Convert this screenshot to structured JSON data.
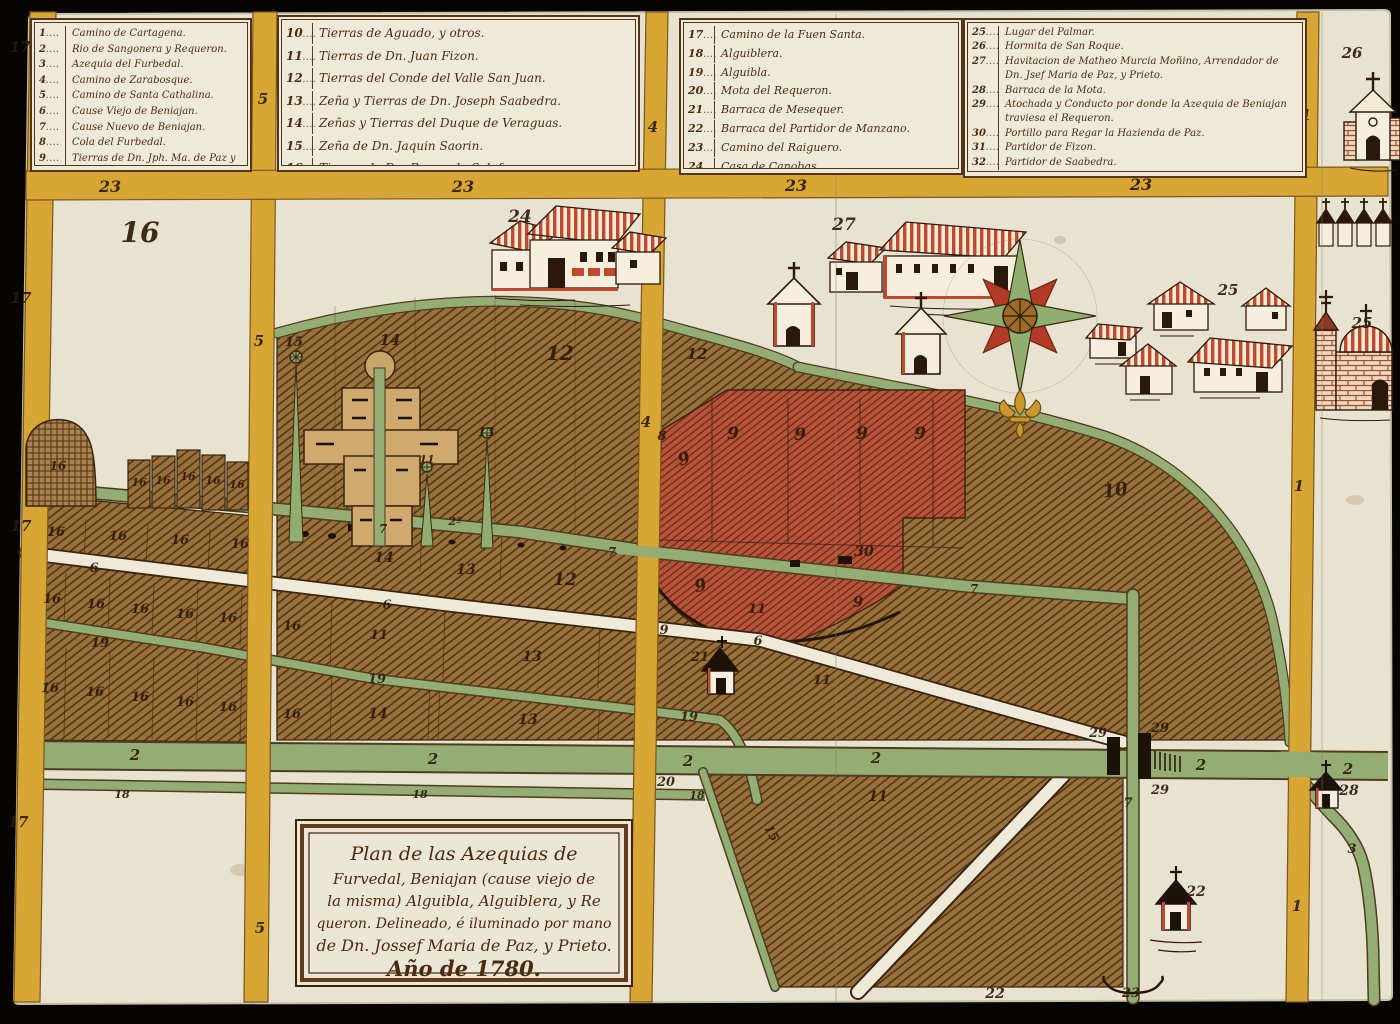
{
  "document_title": "Plan de las Azequias de Furvedal, Beniajan, Alguibla, Alguiblera y Requeron (1780)",
  "legend": {
    "boxes": [
      {
        "items": [
          {
            "num": "1",
            "text": "Camino de Cartagena."
          },
          {
            "num": "2",
            "text": "Rio de Sangonera y Requeron."
          },
          {
            "num": "3",
            "text": "Azequia del Furbedal."
          },
          {
            "num": "4",
            "text": "Camino de Zarabosque."
          },
          {
            "num": "5",
            "text": "Camino de Santa Cathalina."
          },
          {
            "num": "6",
            "text": "Cause Viejo de Beniajan."
          },
          {
            "num": "7",
            "text": "Cause Nuevo de Beniajan."
          },
          {
            "num": "8",
            "text": "Cola del Furbedal."
          },
          {
            "num": "9",
            "text": "Tierras de Dn. Jph. Ma. de Paz y Prieto."
          }
        ]
      },
      {
        "items": [
          {
            "num": "10",
            "text": "Tierras de Aguado, y otros."
          },
          {
            "num": "11",
            "text": "Tierras de Dn. Juan Fizon."
          },
          {
            "num": "12",
            "text": "Tierras del Conde del Valle San Juan."
          },
          {
            "num": "13",
            "text": "Zeña y Tierras de Dn. Joseph Saabedra."
          },
          {
            "num": "14",
            "text": "Zeñas y Tierras del Duque de Veraguas."
          },
          {
            "num": "15",
            "text": "Zeña de Dn. Jaquin Saorin."
          },
          {
            "num": "16",
            "text": "Tierras de Dn. Bernardo Salafranca."
          }
        ]
      },
      {
        "items": [
          {
            "num": "17",
            "text": "Camino de la Fuen Santa."
          },
          {
            "num": "18",
            "text": "Alguiblera."
          },
          {
            "num": "19",
            "text": "Alguibla."
          },
          {
            "num": "20",
            "text": "Mota del Requeron."
          },
          {
            "num": "21",
            "text": "Barraca de Mesequer."
          },
          {
            "num": "22",
            "text": "Barraca del Partidor de Manzano."
          },
          {
            "num": "23",
            "text": "Camino del Raiguero."
          },
          {
            "num": "24",
            "text": "Casa de Canobas."
          }
        ]
      },
      {
        "items": [
          {
            "num": "25",
            "text": "Lugar del Palmar."
          },
          {
            "num": "26",
            "text": "Hormita de San Roque."
          },
          {
            "num": "27",
            "text": "Havitacion de Matheo Murcia Moñino, Arrendador de Dn. Jsef Maria de Paz, y Prieto."
          },
          {
            "num": "28",
            "text": "Barraca de la Mota."
          },
          {
            "num": "29",
            "text": "Atochada y Conducto por donde la Azequia de Beniajan traviesa el Requeron."
          },
          {
            "num": "30",
            "text": "Portillo para Regar la Hazienda de Paz."
          },
          {
            "num": "31",
            "text": "Partidor de Fizon."
          },
          {
            "num": "32",
            "text": "Partidor de Saabedra."
          }
        ]
      }
    ]
  },
  "cartouche": {
    "lines": [
      "Plan de las Azequias de",
      "Furvedal, Beniajan (cause viejo de",
      "la misma) Alguibla, Alguiblera, y Re",
      "queron. Delineado, é iluminado por mano",
      "de Dn. Jossef Maria de Paz, y Prieto.",
      "Año de 1780."
    ]
  },
  "map": {
    "colors": {
      "parchment": "#e8e2d0",
      "legend_parchment": "#efe9da",
      "road_yellow": "#d7a634",
      "canal_green": "#93ad74",
      "field_brown": "#98713c",
      "red_parcel": "#b5543c",
      "roof_red": "#bf4a2e",
      "ink": "#2e1b08",
      "black_bg": "#060503"
    },
    "labels": [
      {
        "t": "17",
        "x": 20,
        "y": 52,
        "s": 15
      },
      {
        "t": "17",
        "x": 21,
        "y": 303,
        "s": 15
      },
      {
        "t": "17",
        "x": 21,
        "y": 531,
        "s": 15
      },
      {
        "t": "17",
        "x": 18,
        "y": 827,
        "s": 15
      },
      {
        "t": "5",
        "x": 263,
        "y": 104,
        "s": 15
      },
      {
        "t": "5",
        "x": 259,
        "y": 346,
        "s": 15
      },
      {
        "t": "5",
        "x": 260,
        "y": 933,
        "s": 15
      },
      {
        "t": "4",
        "x": 653,
        "y": 132,
        "s": 15
      },
      {
        "t": "4",
        "x": 646,
        "y": 427,
        "s": 15
      },
      {
        "t": "1",
        "x": 1306,
        "y": 120,
        "s": 15
      },
      {
        "t": "1",
        "x": 1299,
        "y": 491,
        "s": 15
      },
      {
        "t": "1",
        "x": 1297,
        "y": 911,
        "s": 15
      },
      {
        "t": "23",
        "x": 110,
        "y": 192,
        "s": 16
      },
      {
        "t": "23",
        "x": 463,
        "y": 192,
        "s": 16
      },
      {
        "t": "23",
        "x": 796,
        "y": 191,
        "s": 16
      },
      {
        "t": "23",
        "x": 1141,
        "y": 190,
        "s": 16
      },
      {
        "t": "16",
        "x": 140,
        "y": 242,
        "s": 28
      },
      {
        "t": "24",
        "x": 520,
        "y": 222,
        "s": 17
      },
      {
        "t": "27",
        "x": 844,
        "y": 230,
        "s": 17
      },
      {
        "t": "25",
        "x": 1228,
        "y": 295,
        "s": 15
      },
      {
        "t": "25",
        "x": 1362,
        "y": 328,
        "s": 15
      },
      {
        "t": "26",
        "x": 1352,
        "y": 58,
        "s": 15
      },
      {
        "t": "15",
        "x": 294,
        "y": 346,
        "s": 13
      },
      {
        "t": "14",
        "x": 390,
        "y": 345,
        "s": 15
      },
      {
        "t": "13",
        "x": 486,
        "y": 436,
        "s": 12
      },
      {
        "t": "11",
        "x": 427,
        "y": 463,
        "s": 11
      },
      {
        "t": "12",
        "x": 560,
        "y": 360,
        "s": 20
      },
      {
        "t": "12",
        "x": 697,
        "y": 359,
        "s": 15
      },
      {
        "t": "10",
        "x": 1116,
        "y": 496,
        "s": 18,
        "r": -8
      },
      {
        "t": "8",
        "x": 662,
        "y": 440,
        "s": 13
      },
      {
        "t": "9",
        "x": 686,
        "y": 464,
        "s": 17,
        "r": -20
      },
      {
        "t": "9",
        "x": 733,
        "y": 439,
        "s": 17
      },
      {
        "t": "9",
        "x": 800,
        "y": 440,
        "s": 17
      },
      {
        "t": "9",
        "x": 862,
        "y": 439,
        "s": 17
      },
      {
        "t": "9",
        "x": 920,
        "y": 439,
        "s": 17
      },
      {
        "t": "9",
        "x": 702,
        "y": 591,
        "s": 17,
        "r": -15
      },
      {
        "t": "9",
        "x": 858,
        "y": 607,
        "s": 15
      },
      {
        "t": "9",
        "x": 664,
        "y": 634,
        "s": 13
      },
      {
        "t": "30",
        "x": 864,
        "y": 556,
        "s": 14
      },
      {
        "t": "7",
        "x": 383,
        "y": 533,
        "s": 12
      },
      {
        "t": "7",
        "x": 612,
        "y": 556,
        "s": 12
      },
      {
        "t": "7",
        "x": 974,
        "y": 593,
        "s": 12
      },
      {
        "t": "7",
        "x": 1128,
        "y": 807,
        "s": 13
      },
      {
        "t": "2ª",
        "x": 455,
        "y": 525,
        "s": 11
      },
      {
        "t": "16",
        "x": 58,
        "y": 470,
        "s": 12
      },
      {
        "t": "16",
        "x": 139,
        "y": 486,
        "s": 11
      },
      {
        "t": "16",
        "x": 163,
        "y": 484,
        "s": 11
      },
      {
        "t": "16",
        "x": 188,
        "y": 480,
        "s": 11
      },
      {
        "t": "16",
        "x": 213,
        "y": 484,
        "s": 11
      },
      {
        "t": "16",
        "x": 237,
        "y": 488,
        "s": 11
      },
      {
        "t": "16",
        "x": 56,
        "y": 536,
        "s": 13
      },
      {
        "t": "16",
        "x": 118,
        "y": 540,
        "s": 13
      },
      {
        "t": "16",
        "x": 180,
        "y": 544,
        "s": 13
      },
      {
        "t": "16",
        "x": 240,
        "y": 548,
        "s": 13
      },
      {
        "t": "16",
        "x": 52,
        "y": 603,
        "s": 13
      },
      {
        "t": "16",
        "x": 96,
        "y": 608,
        "s": 13
      },
      {
        "t": "16",
        "x": 140,
        "y": 613,
        "s": 13
      },
      {
        "t": "16",
        "x": 185,
        "y": 618,
        "s": 13
      },
      {
        "t": "16",
        "x": 228,
        "y": 622,
        "s": 13
      },
      {
        "t": "16",
        "x": 292,
        "y": 630,
        "s": 13
      },
      {
        "t": "16",
        "x": 50,
        "y": 692,
        "s": 13
      },
      {
        "t": "16",
        "x": 95,
        "y": 696,
        "s": 13
      },
      {
        "t": "16",
        "x": 140,
        "y": 701,
        "s": 13
      },
      {
        "t": "16",
        "x": 185,
        "y": 706,
        "s": 13
      },
      {
        "t": "16",
        "x": 228,
        "y": 711,
        "s": 13
      },
      {
        "t": "16",
        "x": 292,
        "y": 718,
        "s": 13
      },
      {
        "t": "6",
        "x": 94,
        "y": 572,
        "s": 13
      },
      {
        "t": "6",
        "x": 387,
        "y": 609,
        "s": 13
      },
      {
        "t": "6",
        "x": 758,
        "y": 645,
        "s": 13
      },
      {
        "t": "19",
        "x": 100,
        "y": 647,
        "s": 13
      },
      {
        "t": "19",
        "x": 377,
        "y": 683,
        "s": 13
      },
      {
        "t": "19",
        "x": 689,
        "y": 721,
        "s": 13
      },
      {
        "t": "14",
        "x": 384,
        "y": 562,
        "s": 14
      },
      {
        "t": "13",
        "x": 466,
        "y": 574,
        "s": 14
      },
      {
        "t": "12",
        "x": 565,
        "y": 585,
        "s": 17
      },
      {
        "t": "11",
        "x": 379,
        "y": 639,
        "s": 13
      },
      {
        "t": "14",
        "x": 378,
        "y": 718,
        "s": 14
      },
      {
        "t": "13",
        "x": 532,
        "y": 661,
        "s": 14
      },
      {
        "t": "13",
        "x": 528,
        "y": 724,
        "s": 14
      },
      {
        "t": "11",
        "x": 757,
        "y": 613,
        "s": 13
      },
      {
        "t": "11",
        "x": 822,
        "y": 684,
        "s": 13
      },
      {
        "t": "11",
        "x": 878,
        "y": 801,
        "s": 14
      },
      {
        "t": "21",
        "x": 700,
        "y": 661,
        "s": 13
      },
      {
        "t": "29",
        "x": 1098,
        "y": 737,
        "s": 13
      },
      {
        "t": "29",
        "x": 1160,
        "y": 732,
        "s": 13
      },
      {
        "t": "29",
        "x": 1160,
        "y": 794,
        "s": 13
      },
      {
        "t": "28",
        "x": 1349,
        "y": 795,
        "s": 14
      },
      {
        "t": "2",
        "x": 135,
        "y": 760,
        "s": 15
      },
      {
        "t": "2",
        "x": 433,
        "y": 764,
        "s": 15
      },
      {
        "t": "2",
        "x": 688,
        "y": 766,
        "s": 15
      },
      {
        "t": "2",
        "x": 876,
        "y": 763,
        "s": 15
      },
      {
        "t": "2",
        "x": 1201,
        "y": 770,
        "s": 15
      },
      {
        "t": "2",
        "x": 1348,
        "y": 774,
        "s": 15
      },
      {
        "t": "18",
        "x": 122,
        "y": 798,
        "s": 11
      },
      {
        "t": "18",
        "x": 420,
        "y": 798,
        "s": 11
      },
      {
        "t": "18",
        "x": 697,
        "y": 799,
        "s": 11
      },
      {
        "t": "20",
        "x": 666,
        "y": 786,
        "s": 13
      },
      {
        "t": "3",
        "x": 1352,
        "y": 853,
        "s": 13
      },
      {
        "t": "15",
        "x": 768,
        "y": 835,
        "s": 12,
        "r": 60
      },
      {
        "t": "22",
        "x": 1196,
        "y": 896,
        "s": 14
      },
      {
        "t": "22",
        "x": 995,
        "y": 998,
        "s": 14
      },
      {
        "t": "23",
        "x": 1131,
        "y": 997,
        "s": 13
      }
    ]
  }
}
